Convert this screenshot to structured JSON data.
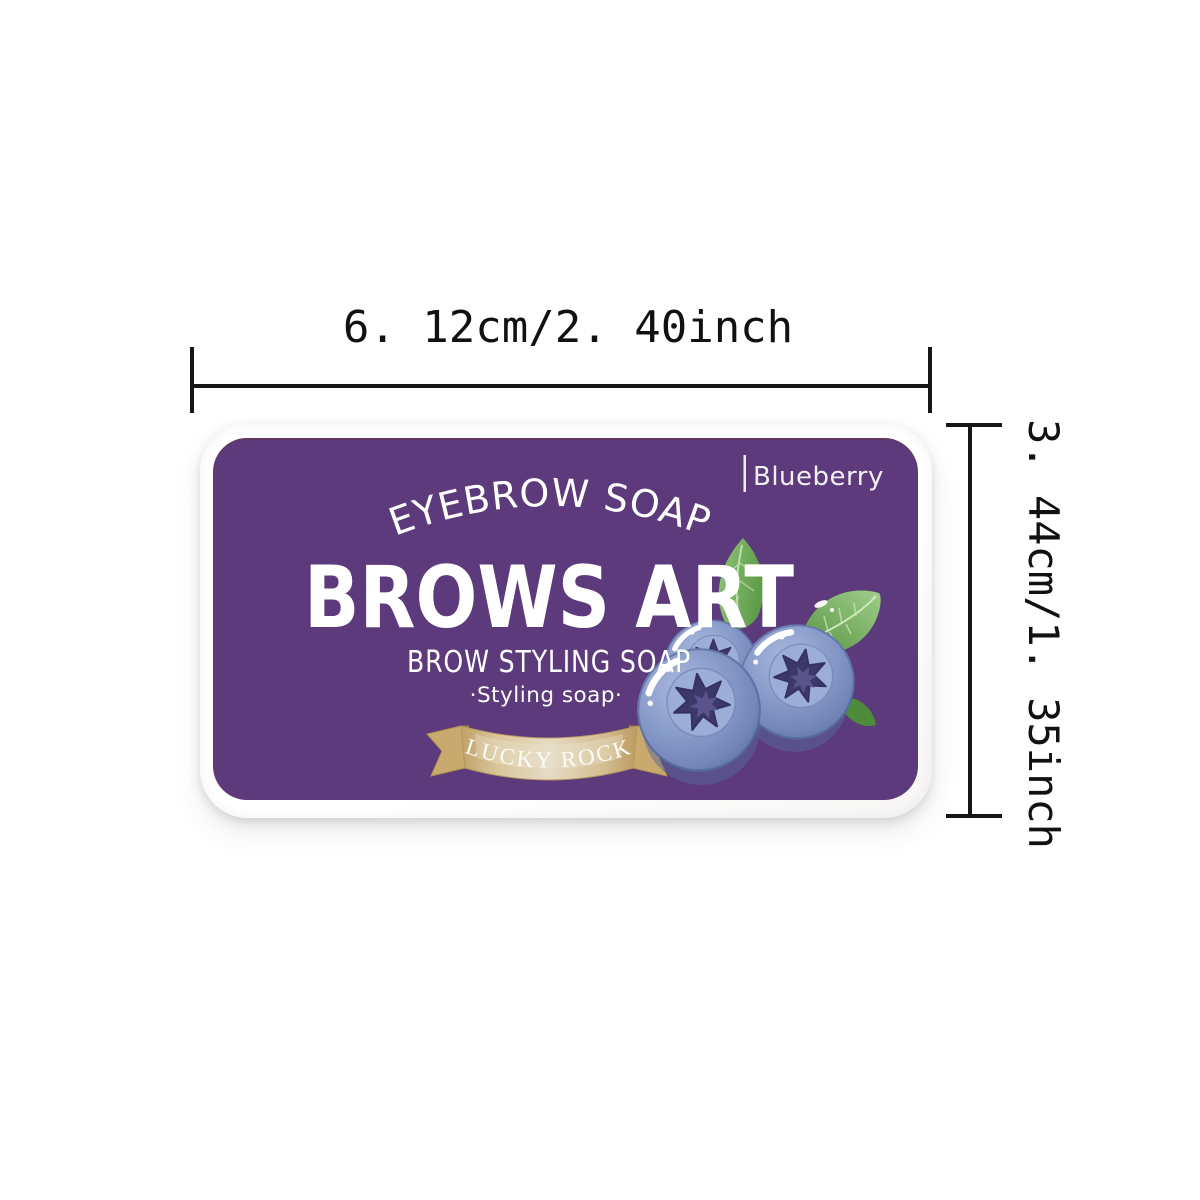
{
  "diagram": {
    "width_label": "6. 12cm/2. 40inch",
    "height_label": "3. 44cm/1. 35inch"
  },
  "label": {
    "flavor": "Blueberry",
    "arc_title": "EYEBROW SOAP",
    "brand": "BROWS ART",
    "subtitle": "BROW STYLING SOAP",
    "tagline": "·Styling soap·",
    "ribbon_text": "LUCKY ROCK"
  },
  "colors": {
    "label_purple": "#5c3a7b",
    "case_white": "#ffffff",
    "ribbon_gold": "#d3b885",
    "berry_blue": "#8296c5",
    "berry_calyx": "#3c3869",
    "leaf_green": "#6fae5a",
    "dimension_ink": "#161616",
    "text_white": "#ffffff"
  }
}
